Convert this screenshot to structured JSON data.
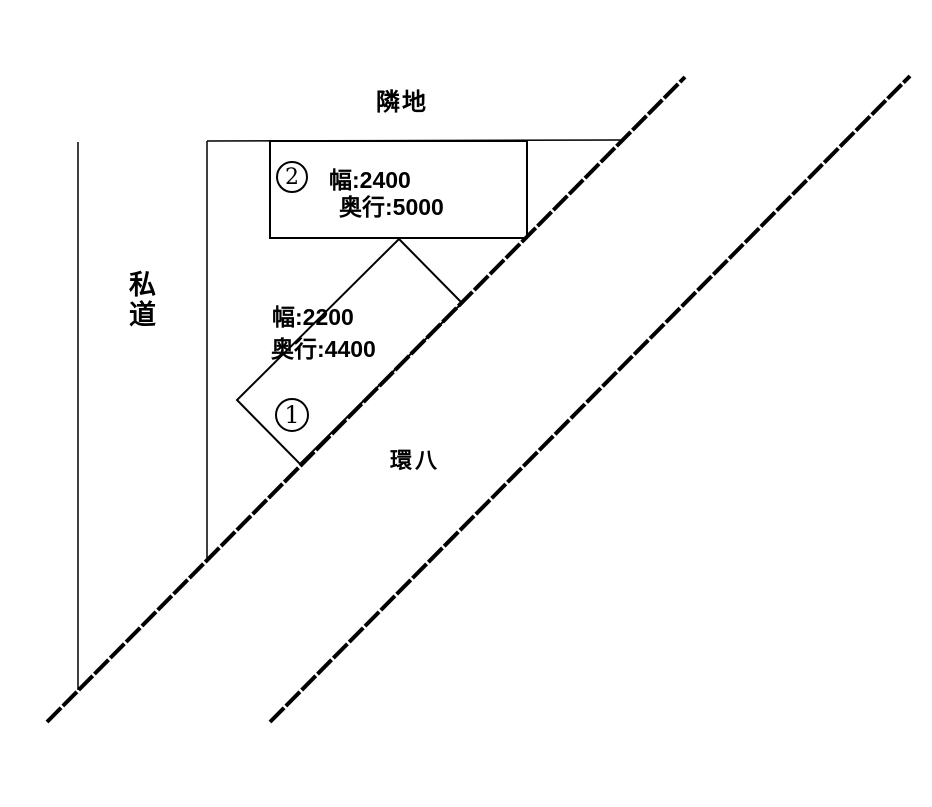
{
  "labels": {
    "neighbor_land": "隣地",
    "private_road": "私道",
    "main_road": "環八"
  },
  "parking_spaces": [
    {
      "number": "1",
      "width_label": "幅:2200",
      "depth_label": "奥行:4400"
    },
    {
      "number": "2",
      "width_label": "幅:2400",
      "depth_label": "奥行:5000"
    }
  ],
  "colors": {
    "line": "#000000",
    "background": "#ffffff"
  }
}
